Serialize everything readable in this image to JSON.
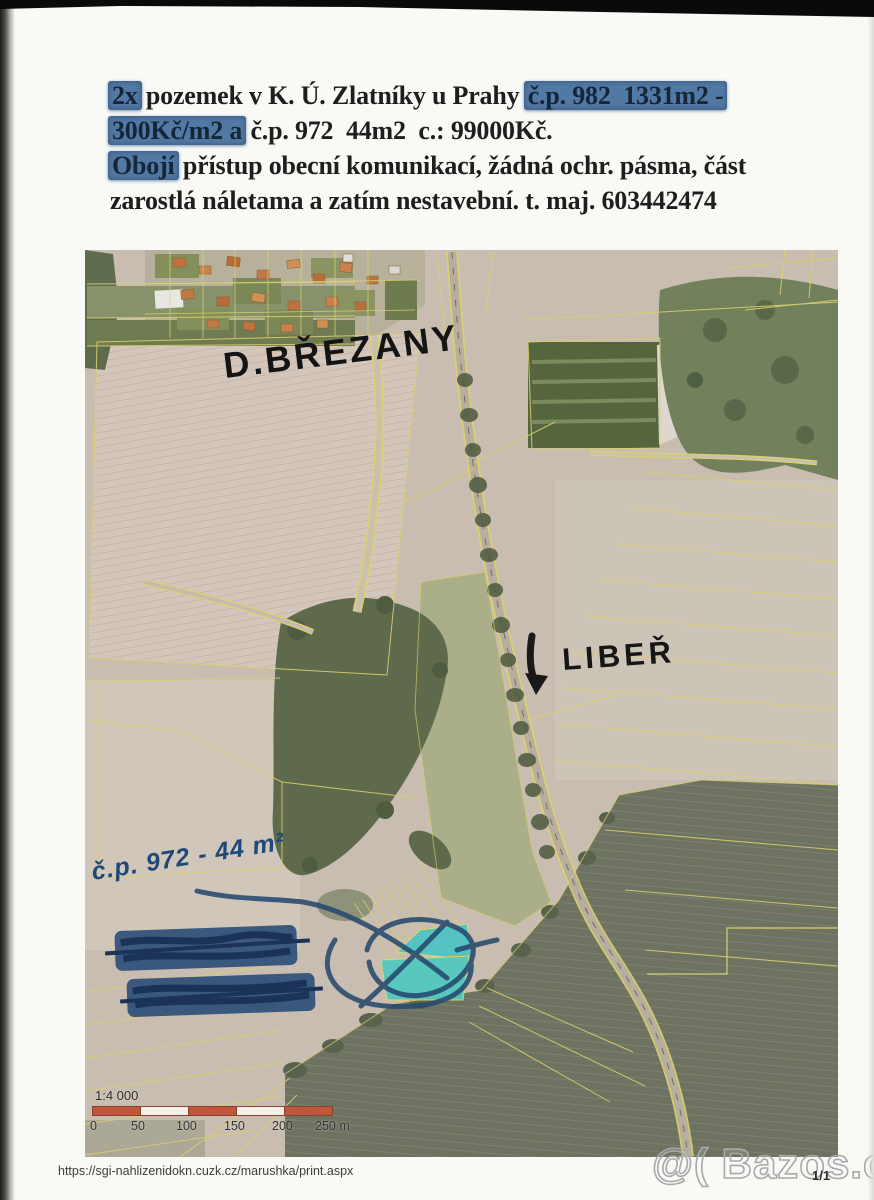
{
  "listing": {
    "line1": {
      "struck_prefix": "2x",
      "main": " pozemek v K. Ú. Zlatníky u Prahy ",
      "struck_suffix": "č.p. 982  1331m2 -"
    },
    "line2": {
      "struck_prefix": "300Kč/m2 a",
      "main": " č.p. 972  44m2  c.: 99000Kč."
    },
    "line3": {
      "struck_prefix": "Obojí",
      "main": " přístup obecní komunikací, žádná ochr. pásma, část"
    },
    "line4": {
      "main": "zarostlá náletama a zatím nestavební. t. maj. 603442474"
    }
  },
  "map": {
    "labels": {
      "village": "D.BŘEZANY",
      "direction": "LIBEŘ",
      "parcel_note": "č.p. 972 - 44 m²"
    },
    "scale": {
      "ratio": "1:4 000",
      "ticks": [
        "0",
        "50",
        "100",
        "150",
        "200",
        "250 m"
      ]
    },
    "colors": {
      "parcel_line": "#d9cf6c",
      "highlight_parcel": "#4fc4c6",
      "pen_blue": "#27496f",
      "marker_black": "#1a1a1a",
      "scale_red": "#c0573d"
    }
  },
  "footer": {
    "url": "https://sgi-nahlizenidokn.cuzk.cz/marushka/print.aspx",
    "page": "1/1",
    "watermark": "@( Bazos.cz"
  }
}
